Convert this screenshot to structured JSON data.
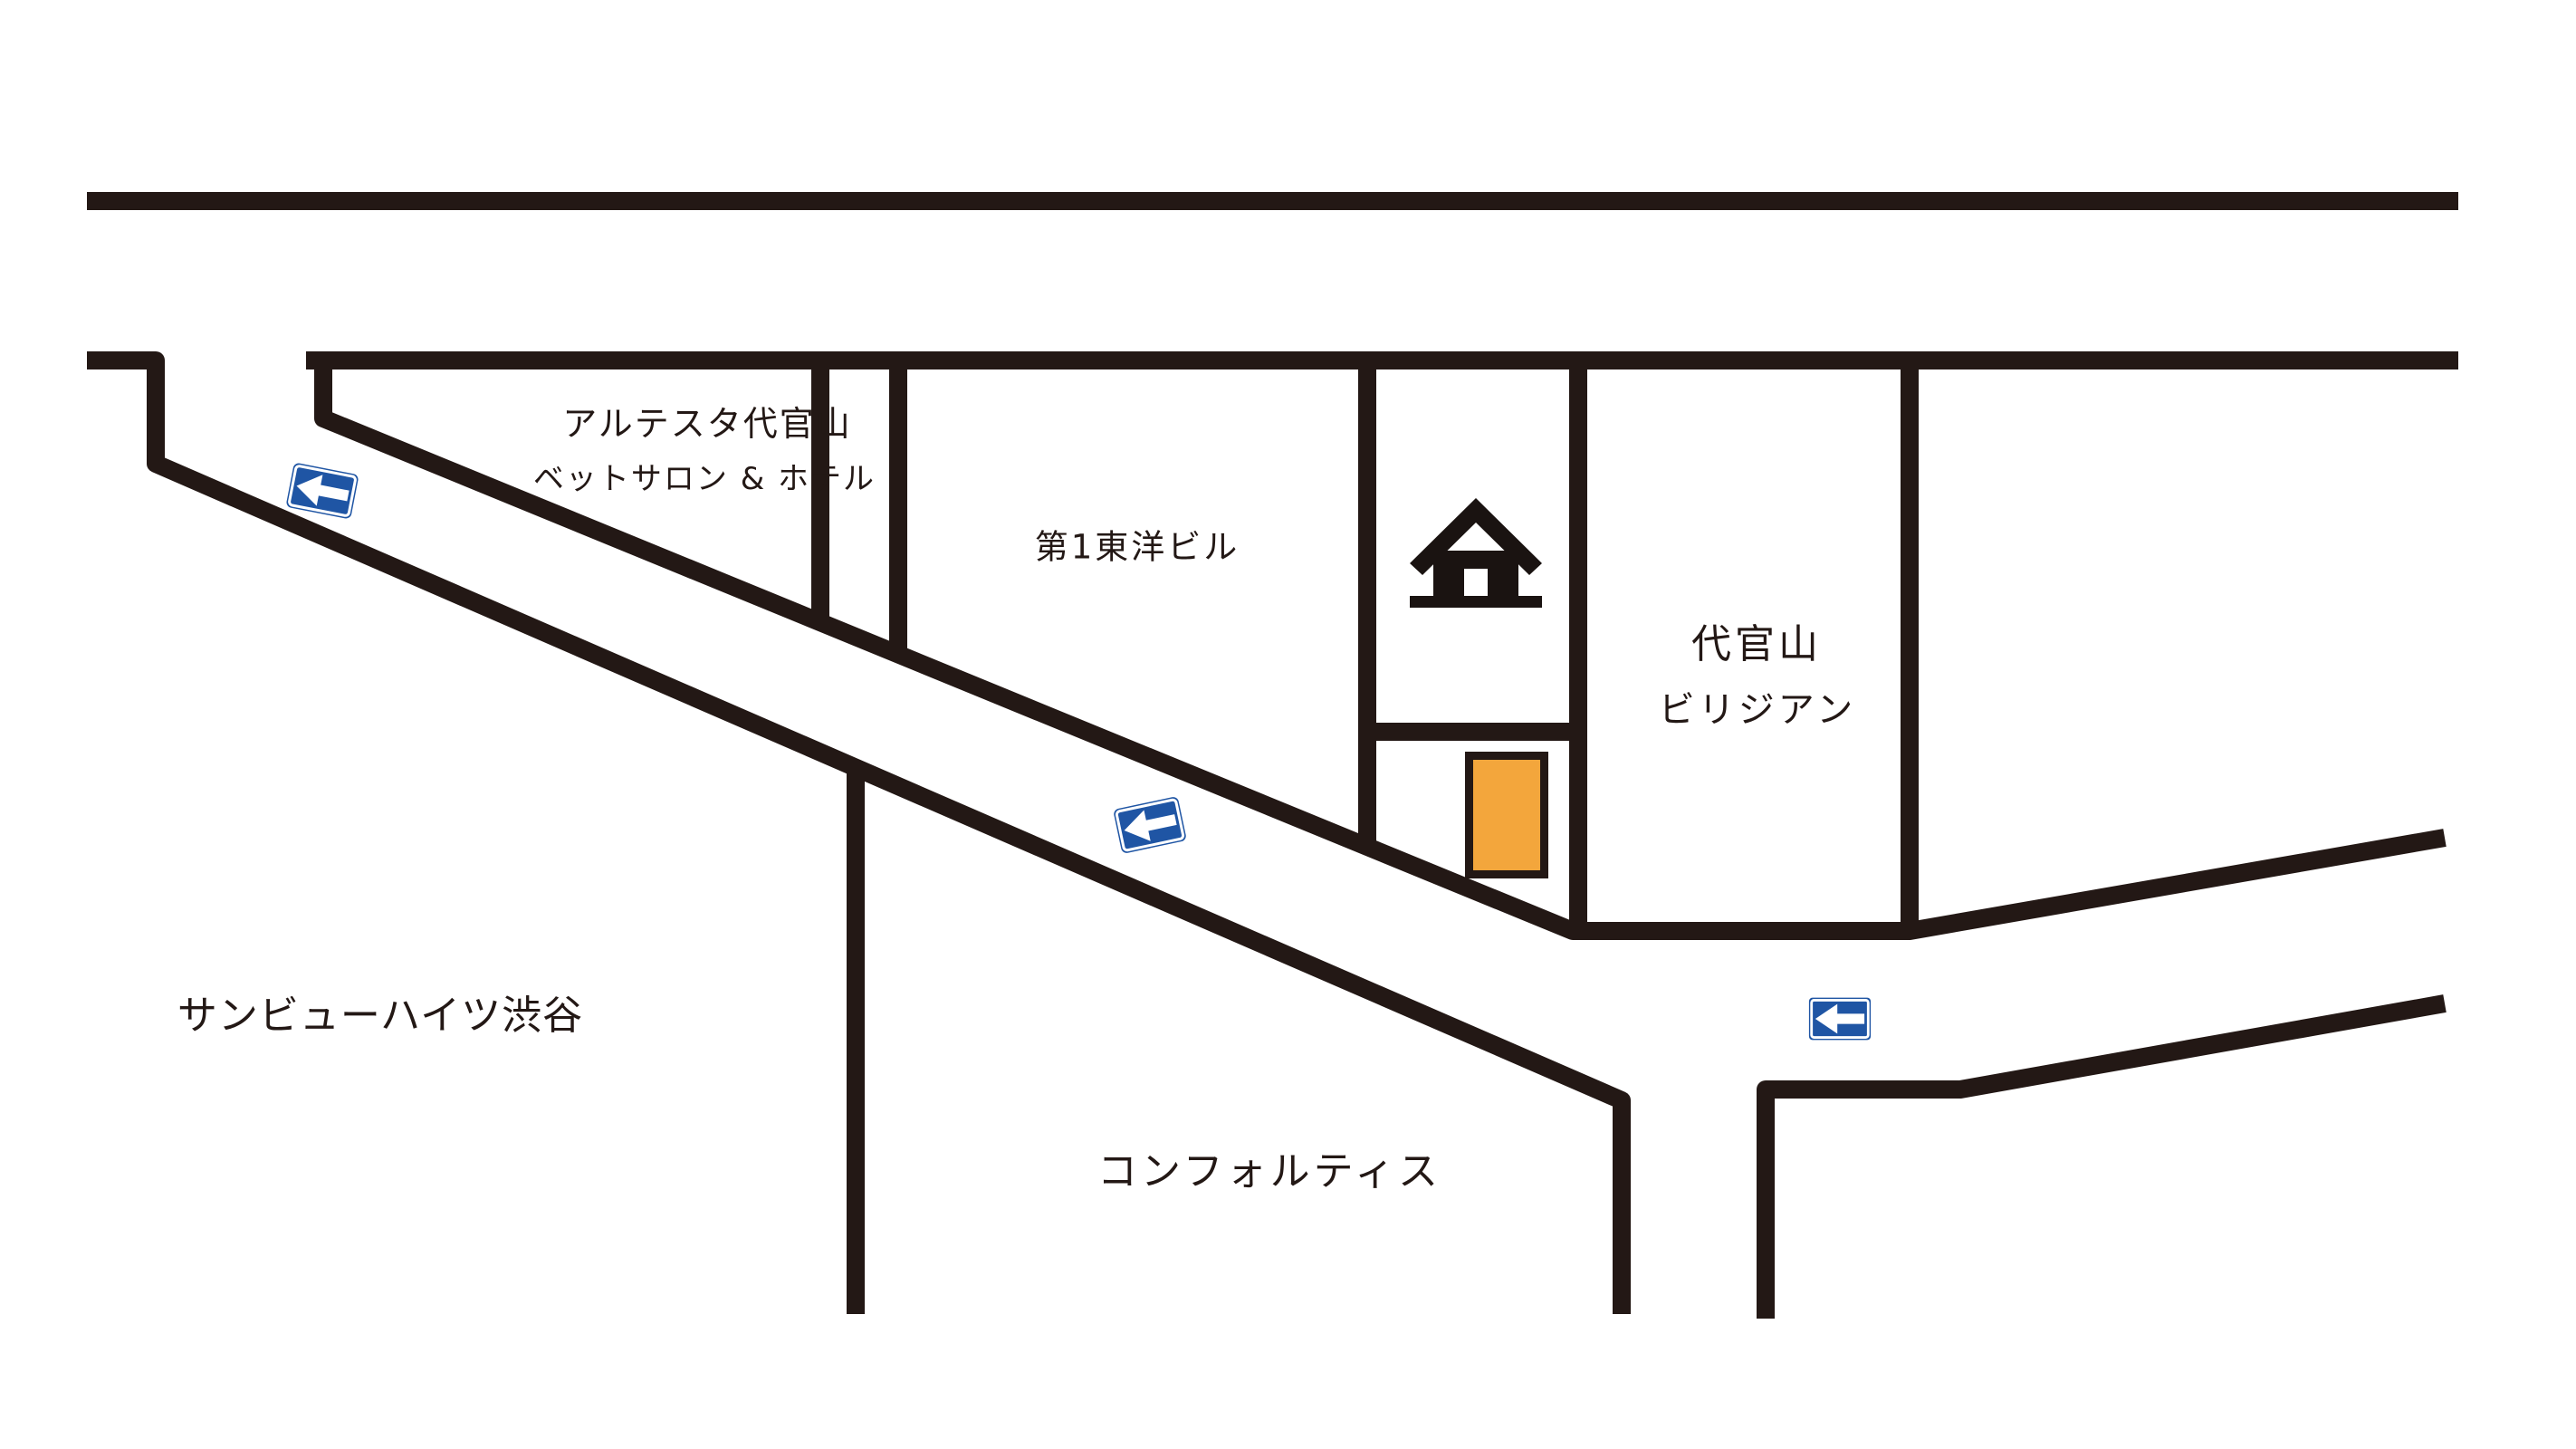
{
  "map": {
    "blocks": {
      "altesta": {
        "name_line1": "アルテスタ代官山",
        "name_line2": "ベットサロン & ホテル"
      },
      "toyo_building": {
        "label": "第1東洋ビル"
      },
      "daikanyama_villian": {
        "name_line1": "代官山",
        "name_line2": "ビリジアン"
      },
      "sunview_heights": {
        "label": "サンビューハイツ渋谷"
      },
      "comfortis": {
        "label": "コンフォルティス"
      }
    },
    "signs": {
      "type": "one-way-left-arrow",
      "count": 3,
      "icon": "left-arrow-icon"
    },
    "icons": {
      "destination": "home-icon",
      "marker": "orange-rectangle-marker"
    },
    "colors": {
      "background": "#FFFFFF",
      "road": "#231815",
      "sign_blue": "#1F55A4",
      "sign_arrow": "#FFFFFF",
      "marker_orange": "#F3A63C",
      "house_black": "#1A1311"
    }
  }
}
